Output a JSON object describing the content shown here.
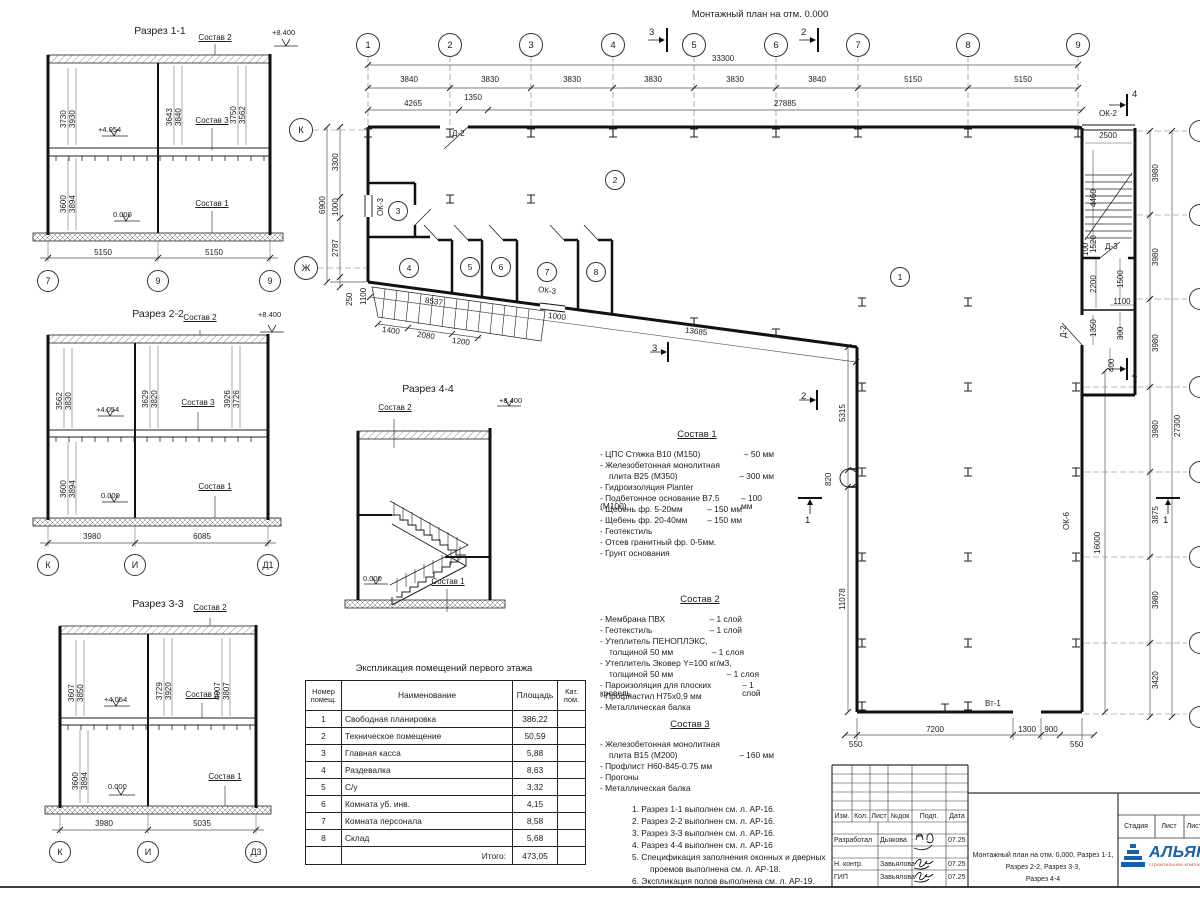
{
  "plan": {
    "title": "Монтажный план на отм. 0.000",
    "axes_top": [
      "1",
      "2",
      "3",
      "4",
      "5",
      "6",
      "7",
      "8",
      "9"
    ],
    "axes_left": [
      "К",
      "Ж"
    ],
    "dims_bays": [
      "3840",
      "3830",
      "3830",
      "3830",
      "3830",
      "3840",
      "5150",
      "5150"
    ],
    "dim_total": "33300",
    "dims_row2": [
      "4265",
      "1350",
      "27885"
    ],
    "dims_left": [
      "3300",
      "1000",
      "2787"
    ],
    "dim_left_total": "6900",
    "dim_250": "250",
    "dim_1100r": "1100",
    "rooms": [
      "1",
      "2",
      "3",
      "4",
      "5",
      "6",
      "7",
      "8"
    ],
    "marks": {
      "s1": "1",
      "s2": "2",
      "s3": "3",
      "s4": "4"
    },
    "tags": {
      "d2": "Д-2",
      "d3": "Д-3",
      "ok2": "ОК-2",
      "ok3": "ОК-3",
      "ok6": "ОК-6",
      "vt1": "Вт-1"
    },
    "dims": {
      "w1400": "1400",
      "w2080": "2080",
      "w1200": "1200",
      "w8537": "8537",
      "w1000": "1000",
      "w13685": "13685",
      "w5315": "5315",
      "w820": "820",
      "w11078": "11078",
      "w2500": "2500",
      "w4460": "4460",
      "w1520": "1520",
      "w100": "100",
      "w2200": "2200",
      "w1500": "1500",
      "w1100": "1100",
      "w1350": "1350",
      "w300": "300",
      "w400": "400",
      "w7200": "7200",
      "w1300": "1300",
      "w900": "900",
      "w550": "550",
      "w16000": "16000",
      "w27300": "27300",
      "w3875": "3875",
      "w3420": "3420",
      "w3980": "3980"
    }
  },
  "sections": {
    "s11": {
      "title": "Разрез 1-1",
      "elev_top": "+8.400",
      "elev_mid": "+4.054",
      "elev_zero": "0.000",
      "sostav1": "Состав 1",
      "sostav2": "Состав 2",
      "sostav3": "Состав 3",
      "du": [
        "3730",
        "3930",
        "3643",
        "3840",
        "3750",
        "3562"
      ],
      "dl": [
        "3600",
        "3894"
      ],
      "db": [
        "5150",
        "5150"
      ],
      "axes": [
        "7",
        "9",
        "9"
      ]
    },
    "s22": {
      "title": "Разрез 2-2",
      "elev_top": "+8.400",
      "elev_mid": "+4.054",
      "elev_zero": "0.000",
      "sostav1": "Состав 1",
      "sostav2": "Состав 2",
      "sostav3": "Состав 3",
      "du": [
        "3562",
        "3830",
        "3629",
        "3820",
        "3926",
        "3726"
      ],
      "dl": [
        "3600",
        "3894"
      ],
      "db": [
        "3980",
        "6085"
      ],
      "axes": [
        "К",
        "И",
        "Д1"
      ]
    },
    "s33": {
      "title": "Разрез 3-3",
      "elev_mid": "+4.054",
      "elev_zero": "0.000",
      "sostav1": "Состав 1",
      "sostav2": "Состав 2",
      "sostav3": "Состав 3",
      "du": [
        "3607",
        "3850",
        "3729",
        "3920",
        "4007",
        "3807"
      ],
      "dl": [
        "3600",
        "3894"
      ],
      "db": [
        "3980",
        "5035"
      ],
      "axes": [
        "К",
        "И",
        "Д3"
      ]
    },
    "s44": {
      "title": "Разрез 4-4",
      "elev_top": "+8.400",
      "elev_zero": "0.000",
      "sostav1": "Состав 1",
      "sostav2": "Состав 2"
    }
  },
  "explication": {
    "title": "Экспликация помещений первого этажа",
    "h1a": "Номер",
    "h1b": "помещ.",
    "h2": "Наименование",
    "h3": "Площадь",
    "h4a": "Кат.",
    "h4b": "пом.",
    "rows": [
      {
        "n": "1",
        "name": "Свободная планировка",
        "area": "386,22"
      },
      {
        "n": "2",
        "name": "Техническое помещение",
        "area": "50,59"
      },
      {
        "n": "3",
        "name": "Главная касса",
        "area": "5,88"
      },
      {
        "n": "4",
        "name": "Раздевалка",
        "area": "8,63"
      },
      {
        "n": "5",
        "name": "С/у",
        "area": "3,32"
      },
      {
        "n": "6",
        "name": "Комната уб. инв.",
        "area": "4,15"
      },
      {
        "n": "7",
        "name": "Комната персонала",
        "area": "8,58"
      },
      {
        "n": "8",
        "name": "Склад",
        "area": "5,68"
      }
    ],
    "total_label": "Итого:",
    "total": "473,05"
  },
  "sostav1": {
    "title": "Состав 1",
    "lines": [
      {
        "l": "- ЦПС Стяжка В10 (М150)",
        "r": "– 50 мм"
      },
      {
        "l": "- Железобетонная монолитная",
        "r": ""
      },
      {
        "l": "плита В25 (М350)",
        "r": "– 300 мм"
      },
      {
        "l": "- Гидроизоляция  Planter",
        "r": ""
      },
      {
        "l": "- Подбетонное основание В7.5 (М100)",
        "r": "– 100 мм"
      },
      {
        "l": "- Щебень фр. 5-20мм",
        "r": "– 150 мм"
      },
      {
        "l": "- Щебень фр. 20-40мм",
        "r": "– 150 мм"
      },
      {
        "l": "- Геотекстиль",
        "r": ""
      },
      {
        "l": "- Отсев гранитный фр. 0-5мм.",
        "r": ""
      },
      {
        "l": "- Грунт основания",
        "r": ""
      }
    ]
  },
  "sostav2": {
    "title": "Состав 2",
    "lines": [
      {
        "l": "- Мембрана ПВХ",
        "r": "– 1 слой"
      },
      {
        "l": "- Геотекстиль",
        "r": "– 1 слой"
      },
      {
        "l": "- Утеплитель ПЕНОПЛЭКС,",
        "r": ""
      },
      {
        "l": "толщиной 50 мм",
        "r": "– 1 слоя"
      },
      {
        "l": "- Утеплитель Эковер Y=100 кг/м3,",
        "r": ""
      },
      {
        "l": "толщиной 50 мм",
        "r": "– 1 слоя"
      },
      {
        "l": "- Пароизоляция для плоских кровель",
        "r": "– 1 слой"
      },
      {
        "l": "- Профнастил Н75х0,9 мм",
        "r": ""
      },
      {
        "l": "- Металлическая балка",
        "r": ""
      }
    ]
  },
  "sostav3": {
    "title": "Состав 3",
    "lines": [
      {
        "l": "- Железобетонная монолитная",
        "r": ""
      },
      {
        "l": "плита В15 (М200)",
        "r": "– 160 мм"
      },
      {
        "l": "- Профлист Н60-845-0.75 мм",
        "r": ""
      },
      {
        "l": "- Прогоны",
        "r": ""
      },
      {
        "l": "- Металлическая балка",
        "r": ""
      }
    ]
  },
  "notes": [
    "1. Разрез 1-1 выполнен см. л. АР-16.",
    "2. Разрез 2-2 выполнен см. л. АР-16.",
    "3. Разрез 3-3 выполнен см. л. АР-16.",
    "4. Разрез 4-4 выполнен см. л. АР-16",
    "5. Спецификация заполнения оконных и дверных",
    "проемов выполнена см. л. АР-18.",
    "6. Экспликация полов выполнена см. л. АР-19."
  ],
  "titleblock": {
    "cols": [
      "Изм.",
      "Кол.",
      "Лист",
      "№док",
      "Подп.",
      "Дата"
    ],
    "rows": [
      {
        "role": "Разработал",
        "name": "Дьякова",
        "date": "07.25"
      },
      {
        "role": "Н. контр.",
        "name": "Завьялова",
        "date": "07.25"
      },
      {
        "role": "ГИП",
        "name": "Завьялова",
        "date": "07.25"
      }
    ],
    "doc_title_1": "Монтажный план на отм. 0,000, Разрез 1-1,",
    "doc_title_2": "Разрез 2-2, Разрез 3-3,",
    "doc_title_3": "Разрез 4-4",
    "stage_cols": [
      "Стадия",
      "Лист",
      "Листов"
    ],
    "logo_text": "АЛЬЯНС",
    "logo_sub": "строительная компания",
    "logo_color": "#1460aa",
    "logo_sub_color": "#c43a2e"
  }
}
